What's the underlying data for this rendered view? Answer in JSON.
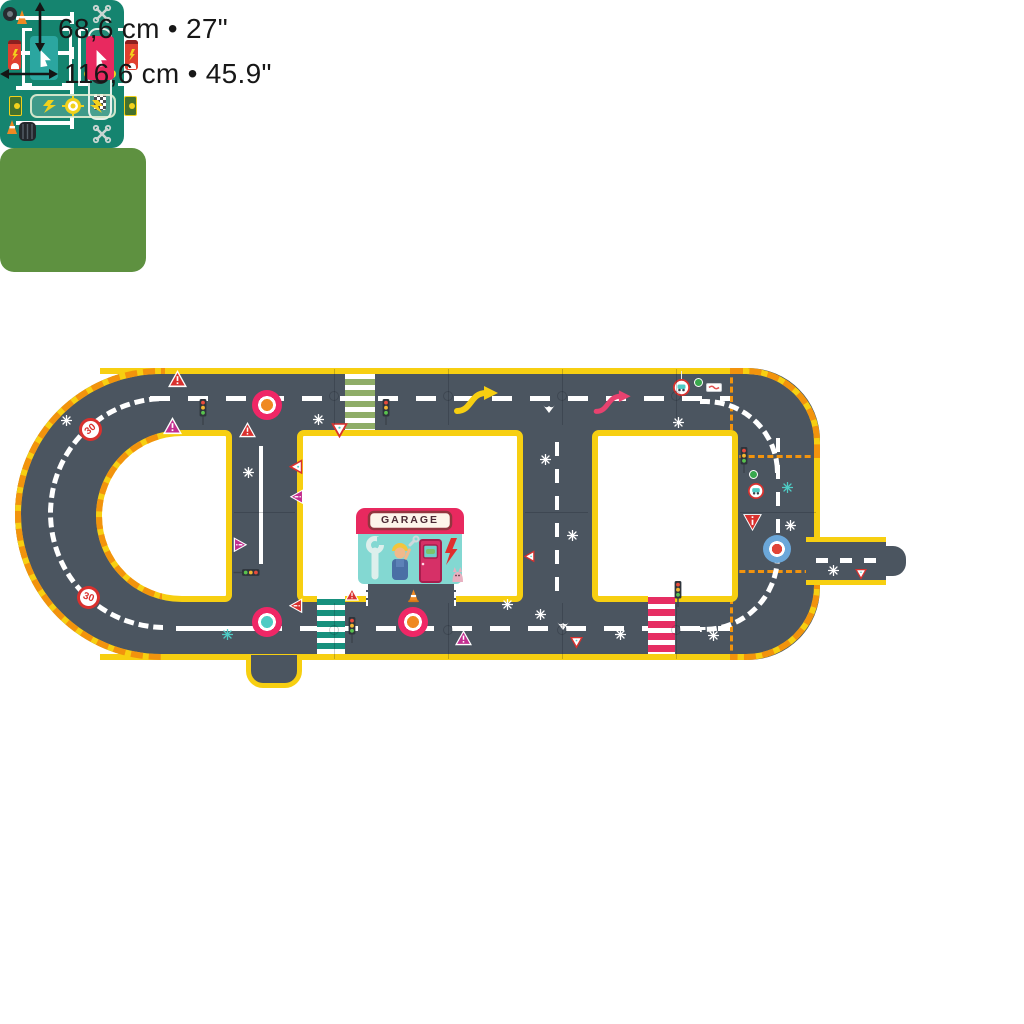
{
  "annotations": {
    "height_label": "68,6 cm • 27\"",
    "width_label": "116,6 cm • 45.9\""
  },
  "garage": {
    "sign_text": "GARAGE"
  },
  "road_signs": {
    "speed_limit_value": "30"
  },
  "colors": {
    "road": "#4b5560",
    "edge_yellow": "#f7cf11",
    "hazard_orange": "#f2930d",
    "marking_white": "#ffffff",
    "crosswalk_green": "#8fad68",
    "crosswalk_teal": "#17907d",
    "crosswalk_pink": "#e62e63",
    "parking_teal": "#15846f",
    "charging_green": "#5e9140",
    "sign_red": "#d9312e",
    "sign_magenta": "#c22f90",
    "accent_pink": "#ef2766",
    "accent_orange": "#ef8922",
    "accent_teal": "#4fcbc4",
    "accent_blue": "#6ba7d9"
  },
  "icons": {
    "traffic-light-icon": "three-dot signal",
    "speed-limit-sign": "red ring circle with 30",
    "yield-sign-icon": "inverted red/white triangle",
    "warning-sign-icon": "triangle with exclamation",
    "roundabout-marking": "concentric painted circles",
    "crosswalk": "striped pedestrian band",
    "wrench-icon": "crossed wrenches",
    "checkered-flag-icon": "black/white checker strip",
    "tire-icon": "tire",
    "cone-icon": "traffic cone",
    "lightning-icon": "bolt",
    "charging-pad-icon": "arrow pad in brackets",
    "fuel-pump-icon": "charging pump",
    "sun-emblem-icon": "starburst badge",
    "curve-arrow-icon": "double-bend arrow",
    "route-bird-marking-icon": "white chevron mark",
    "sparkle-icon": "asterisk sparkle",
    "height-arrow-icon": "vertical double arrow",
    "width-arrow-icon": "horizontal double arrow",
    "mechanic-figure": "mechanic with wrench",
    "cat-icon": "cat",
    "garage-door-icon": "door with window"
  }
}
